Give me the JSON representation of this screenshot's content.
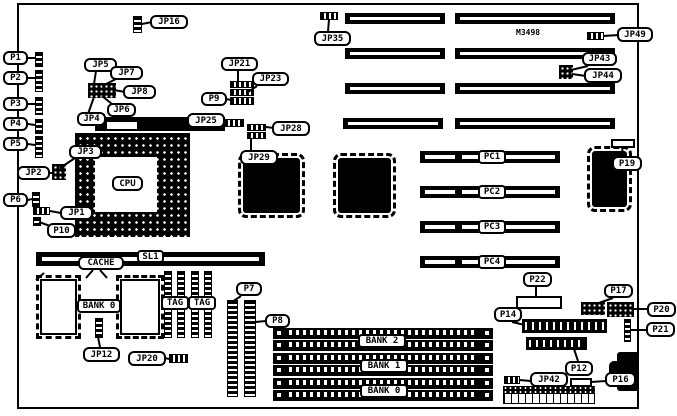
{
  "colors": {
    "ink": "#000000",
    "paper": "#ffffff"
  },
  "board": {
    "marking": "M3498"
  },
  "callouts": {
    "jp16": "JP16",
    "jp35": "JP35",
    "jp49": "JP49",
    "jp43": "JP43",
    "jp44": "JP44",
    "p1": "P1",
    "p2": "P2",
    "p3": "P3",
    "p4": "P4",
    "p5": "P5",
    "p6": "P6",
    "jp2": "JP2",
    "jp3": "JP3",
    "jp1": "JP1",
    "p10": "P10",
    "jp5": "JP5",
    "jp7": "JP7",
    "jp8": "JP8",
    "jp6": "JP6",
    "jp4": "JP4",
    "jp21": "JP21",
    "jp23": "JP23",
    "p9": "P9",
    "jp25": "JP25",
    "jp28": "JP28",
    "jp29": "JP29",
    "cpu": "CPU",
    "p19": "P19",
    "pc1": "PC1",
    "pc2": "PC2",
    "pc3": "PC3",
    "pc4": "PC4",
    "cache": "CACHE",
    "sl1": "SL1",
    "cache_bank0": "BANK 0",
    "tag1": "TAG",
    "tag2": "TAG",
    "jp12": "JP12",
    "jp20": "JP20",
    "p7": "P7",
    "p8": "P8",
    "bank2": "BANK 2",
    "bank1": "BANK 1",
    "bank0": "BANK 0",
    "p22": "P22",
    "p17": "P17",
    "p20": "P20",
    "p14": "P14",
    "p21": "P21",
    "p12": "P12",
    "jp42": "JP42",
    "p16": "P16"
  }
}
